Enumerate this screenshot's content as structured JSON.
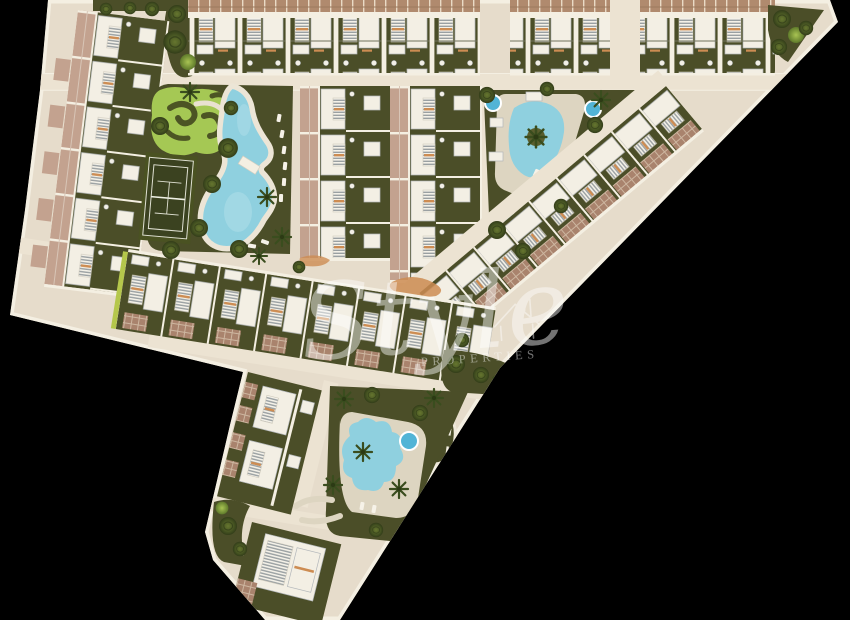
{
  "watermark": {
    "script": "Style",
    "caption": "PROPERTIES",
    "color": "#ffffff",
    "opacity": 0.45
  },
  "palette": {
    "background": "#000000",
    "site_base": "#e6dccb",
    "road": "#ece3d2",
    "walk": "#f4efe2",
    "garden": "#4b4e28",
    "garden_light": "#5a5e2e",
    "lawn": "#a5c854",
    "lawn_curl": "#4c5424",
    "pool_water": "#8fd0df",
    "pool_water_deep": "#63bcd4",
    "spa_water": "#52b4d6",
    "pool_deck": "#ddd5c1",
    "roof_terracotta": "#b08a6e",
    "roof_mauve": "#c3a28f",
    "brick_paver": "#a9836d",
    "building": "#f3efe4",
    "building_edge": "#b3b7ba",
    "accent_orange": "#cd8c52",
    "dot": "#f2efe6",
    "tennis_court": "#3b4220",
    "tennis_line": "#e9ebdd",
    "hedge": "#b5c74b"
  },
  "features": [
    {
      "name": "townhouse-row-top-left",
      "kind": "residential-block"
    },
    {
      "name": "townhouse-row-top-mid",
      "kind": "residential-block"
    },
    {
      "name": "townhouse-row-top-right",
      "kind": "residential-block"
    },
    {
      "name": "apartments-column-west",
      "kind": "residential-block"
    },
    {
      "name": "apartments-column-central-1",
      "kind": "residential-block"
    },
    {
      "name": "apartments-column-central-2",
      "kind": "residential-block"
    },
    {
      "name": "diagonal-townhouse-row",
      "kind": "residential-block"
    },
    {
      "name": "lower-townhouse-row",
      "kind": "residential-block"
    },
    {
      "name": "peninsula-apartment-block",
      "kind": "residential-block"
    },
    {
      "name": "peninsula-south-building",
      "kind": "residential-block"
    },
    {
      "name": "central-garden",
      "kind": "garden"
    },
    {
      "name": "ornamental-lawn",
      "kind": "garden"
    },
    {
      "name": "tennis-court",
      "kind": "sport"
    },
    {
      "name": "lagoon-pool",
      "kind": "pool"
    },
    {
      "name": "teardrop-pool",
      "kind": "pool"
    },
    {
      "name": "peninsula-pool",
      "kind": "pool"
    },
    {
      "name": "spa-circles",
      "kind": "pool"
    },
    {
      "name": "roundabout-garden",
      "kind": "garden"
    }
  ]
}
